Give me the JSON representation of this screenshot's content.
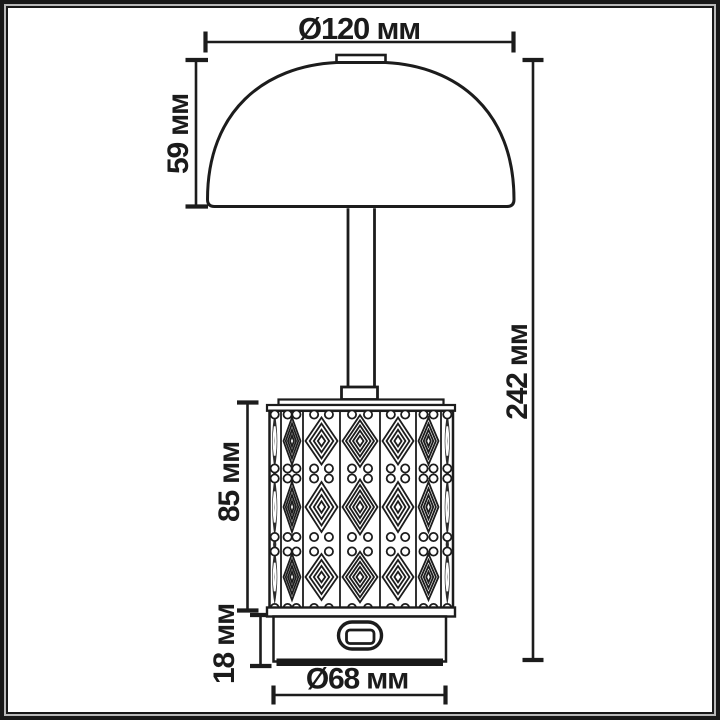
{
  "drawing": {
    "subject": "table lamp with dome shade and patterned cylindrical body",
    "dimension_labels": {
      "shade_diameter": "Ø120 мм",
      "shade_height": "59 мм",
      "body_height": "85 мм",
      "base_height": "18 мм",
      "base_diameter": "Ø68 мм",
      "total_height": "242 мм"
    },
    "colors": {
      "line": "#1c1c1c",
      "background": "#ffffff",
      "frame_dark": "#181818",
      "frame_light": "#b8b8b8"
    }
  }
}
